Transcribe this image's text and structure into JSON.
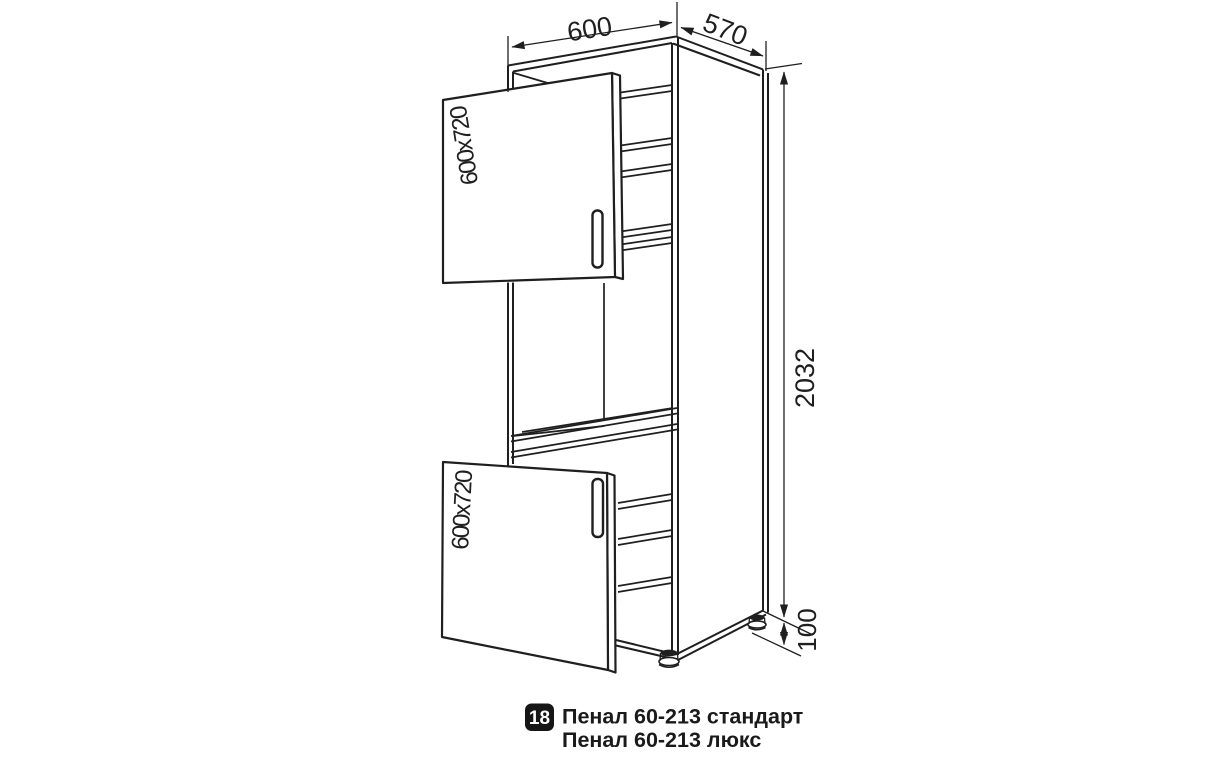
{
  "drawing": {
    "dimensions": {
      "width": "600",
      "depth": "570",
      "height": "2032",
      "legs": "100"
    },
    "doors": {
      "top_label": "600x720",
      "bottom_label": "600x720"
    }
  },
  "caption": {
    "number": "18",
    "line1": "Пенал 60-213 стандарт",
    "line2": "Пенал 60-213 люкс"
  },
  "colors": {
    "line": "#1f1f1f",
    "badge_bg": "#161616",
    "badge_text": "#ffffff",
    "background": "#ffffff"
  }
}
